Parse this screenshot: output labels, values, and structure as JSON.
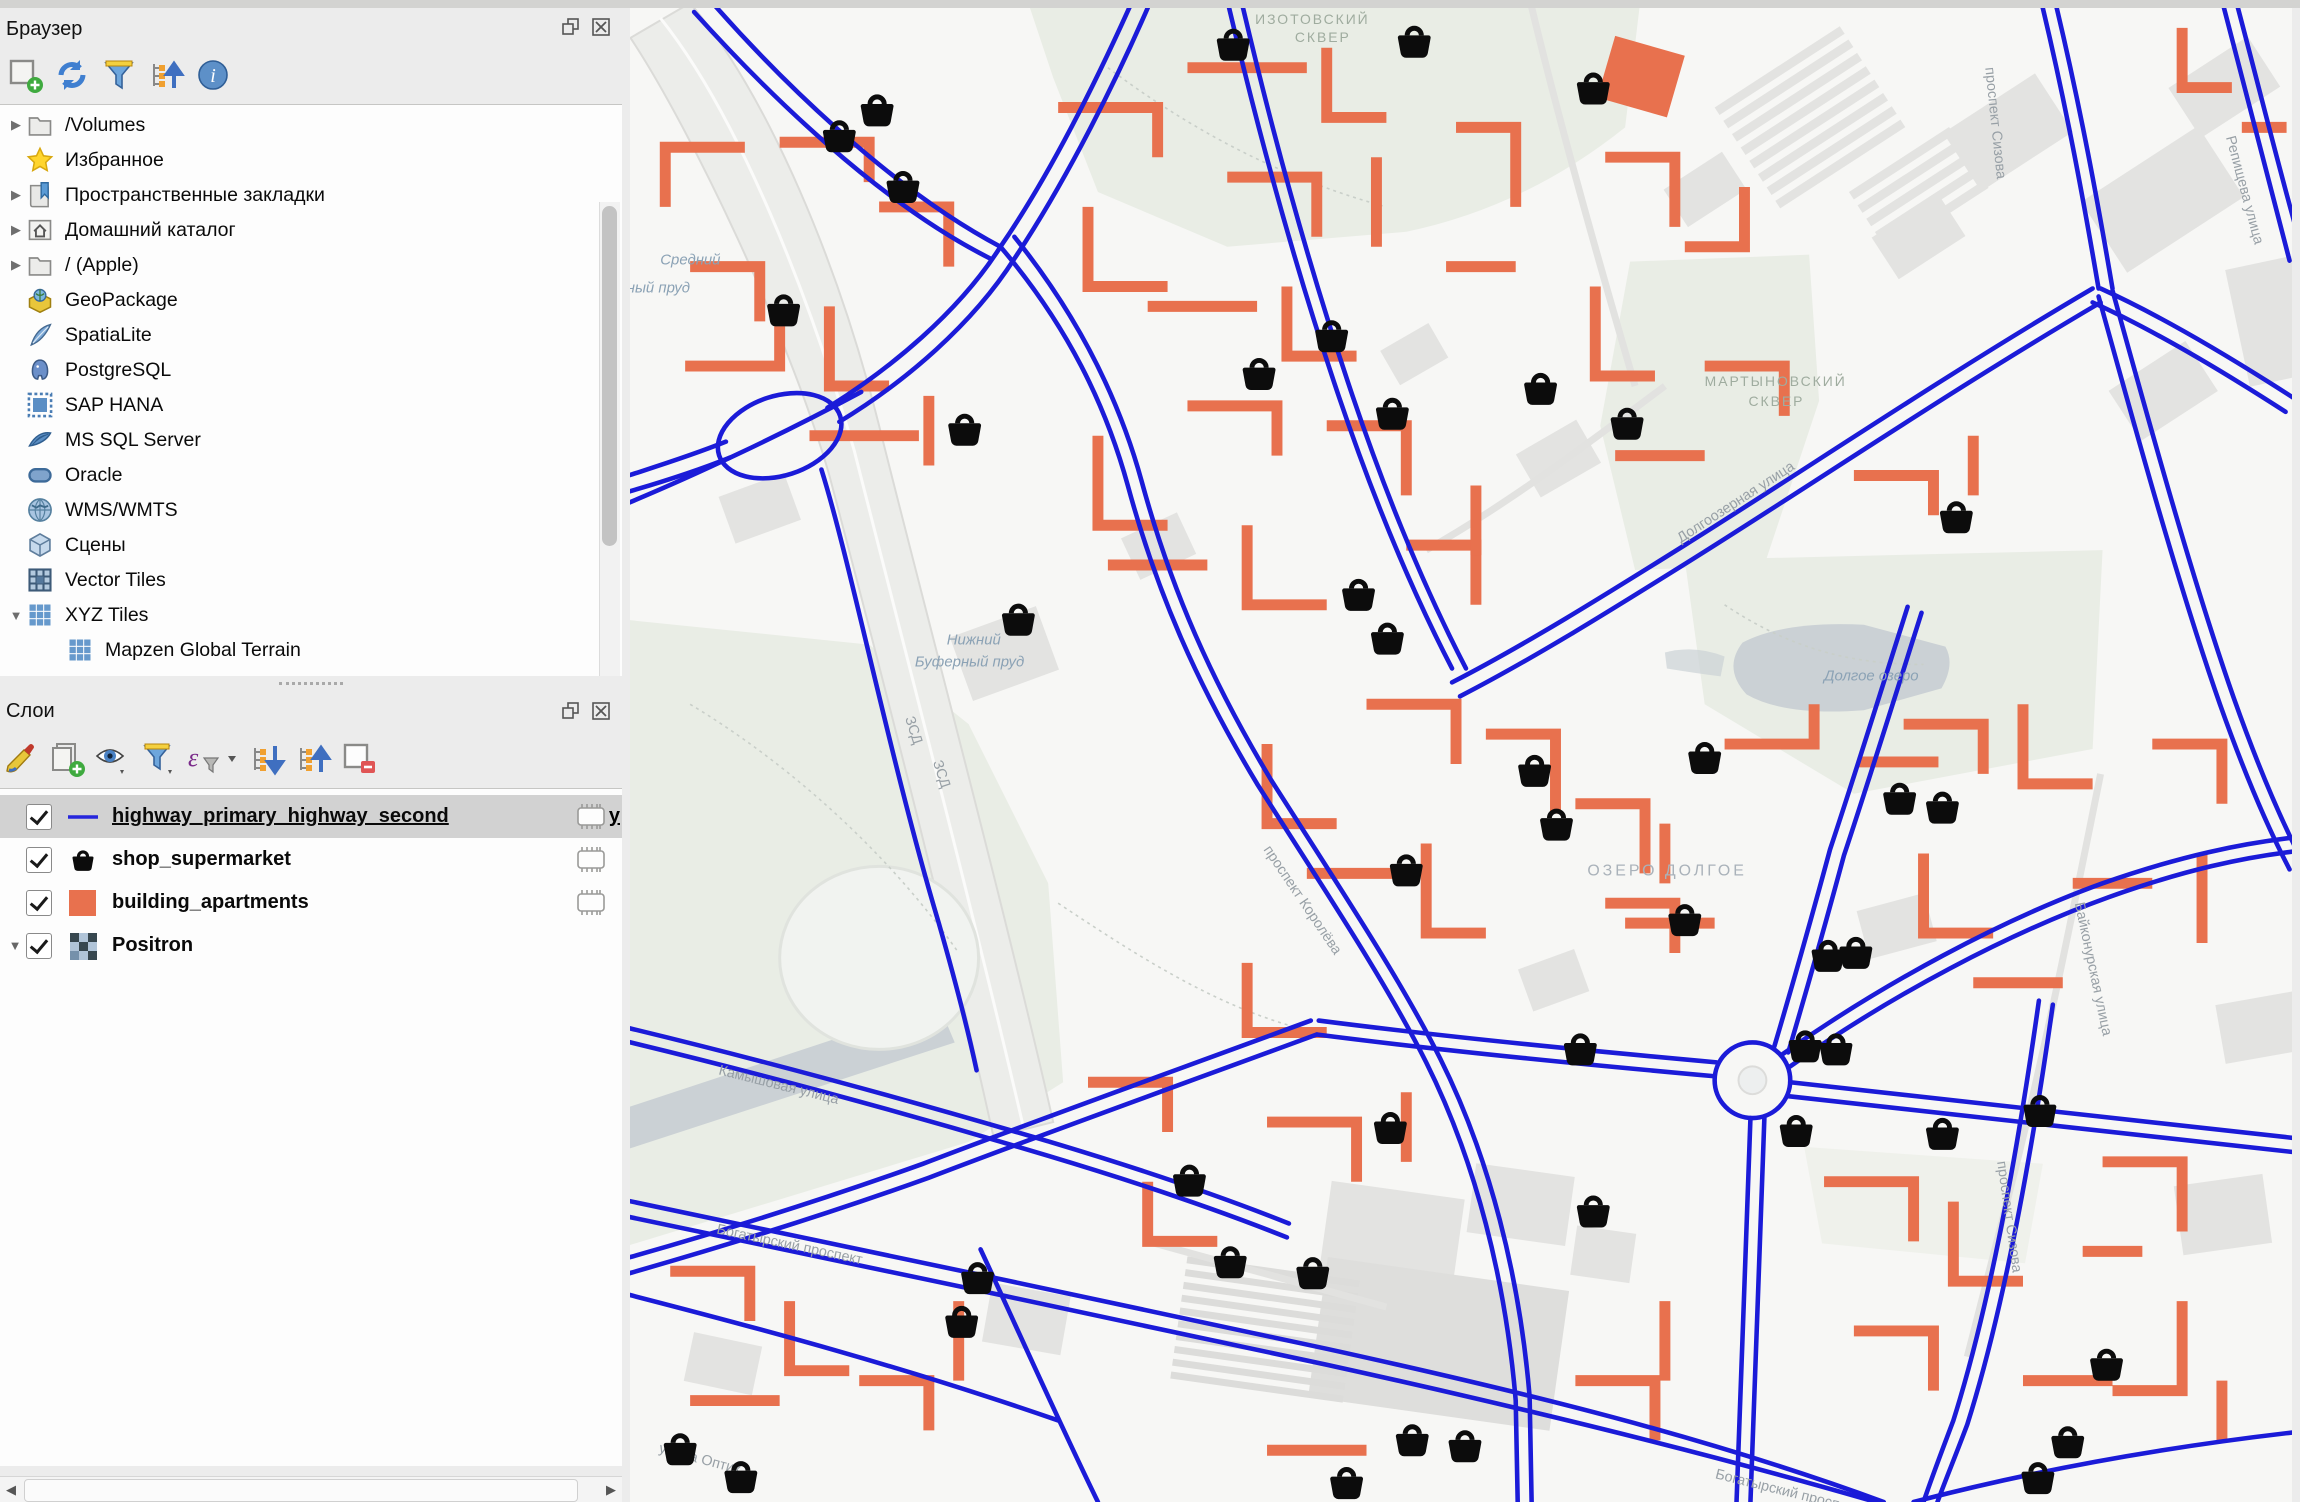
{
  "browser_panel": {
    "title": "Браузер",
    "toolbar": [
      {
        "name": "add-favorite",
        "icon": "add-square-icon"
      },
      {
        "name": "refresh",
        "icon": "refresh-icon"
      },
      {
        "name": "filter-browser",
        "icon": "filter-icon"
      },
      {
        "name": "collapse-all",
        "icon": "collapse-tree-icon"
      },
      {
        "name": "properties",
        "icon": "info-icon"
      }
    ],
    "items": [
      {
        "label": "/Volumes",
        "icon": "folder-icon",
        "expander": "collapsed"
      },
      {
        "label": "Избранное",
        "icon": "star-icon",
        "expander": "none"
      },
      {
        "label": "Пространственные закладки",
        "icon": "bookmarks-icon",
        "expander": "collapsed"
      },
      {
        "label": "Домашний каталог",
        "icon": "home-folder-icon",
        "expander": "collapsed"
      },
      {
        "label": "/ (Apple)",
        "icon": "folder-icon",
        "expander": "collapsed"
      },
      {
        "label": "GeoPackage",
        "icon": "geopackage-icon",
        "expander": "none"
      },
      {
        "label": "SpatiaLite",
        "icon": "spatialite-icon",
        "expander": "none"
      },
      {
        "label": "PostgreSQL",
        "icon": "postgresql-icon",
        "expander": "none"
      },
      {
        "label": "SAP HANA",
        "icon": "sap-hana-icon",
        "expander": "none"
      },
      {
        "label": "MS SQL Server",
        "icon": "mssql-icon",
        "expander": "none"
      },
      {
        "label": "Oracle",
        "icon": "oracle-icon",
        "expander": "none"
      },
      {
        "label": "WMS/WMTS",
        "icon": "wms-icon",
        "expander": "none"
      },
      {
        "label": "Сцены",
        "icon": "scenes-icon",
        "expander": "none"
      },
      {
        "label": "Vector Tiles",
        "icon": "vector-tiles-icon",
        "expander": "none"
      },
      {
        "label": "XYZ Tiles",
        "icon": "xyz-tiles-icon",
        "expander": "expanded"
      },
      {
        "label": "Mapzen Global Terrain",
        "icon": "xyz-tiles-icon",
        "expander": "none",
        "indent": 1
      }
    ]
  },
  "layers_panel": {
    "title": "Слои",
    "toolbar": [
      {
        "name": "layer-styling",
        "icon": "paintbrush-icon"
      },
      {
        "name": "add-group",
        "icon": "add-group-icon"
      },
      {
        "name": "manage-visibility",
        "icon": "eye-icon"
      },
      {
        "name": "filter-legend",
        "icon": "filter-icon"
      },
      {
        "name": "filter-by-expression",
        "icon": "expression-filter-icon"
      },
      {
        "name": "expand-all",
        "icon": "expand-tree-icon"
      },
      {
        "name": "collapse-all",
        "icon": "collapse-tree-icon"
      },
      {
        "name": "remove-layer",
        "icon": "remove-layer-icon"
      }
    ],
    "layers": [
      {
        "label": "highway_primary_highway_second",
        "label_tail": "y",
        "checked": true,
        "selected": true,
        "swatch": "blue-line",
        "swatch_color": "#2626DC",
        "memory_indicator": true
      },
      {
        "label": "shop_supermarket",
        "checked": true,
        "selected": false,
        "swatch": "basket-marker",
        "swatch_color": "#0C0C0C",
        "memory_indicator": true
      },
      {
        "label": "building_apartments",
        "checked": true,
        "selected": false,
        "swatch": "fill-square",
        "swatch_color": "#E8714E",
        "memory_indicator": true
      },
      {
        "label": "Positron",
        "checked": true,
        "selected": false,
        "swatch": "raster-checker",
        "expander": "expanded",
        "memory_indicator": false
      }
    ]
  },
  "map": {
    "basemap": "Positron",
    "colors": {
      "road_blue": "#1B1BD8",
      "building_orange": "#E8714E",
      "marker_black": "#0C0C0C",
      "park_green": "#E9EDE5",
      "water_gray": "#CBD1D5",
      "basemap_building": "#E3E3E1",
      "background": "#F7F7F5"
    },
    "marker": "shopping-basket-icon",
    "marker_count": 47,
    "labels": [
      {
        "text": "ИЗОТОВСКИЙ",
        "x": 628,
        "y": 16,
        "type": "park"
      },
      {
        "text": "СКВЕР",
        "x": 668,
        "y": 34,
        "type": "park"
      },
      {
        "text": "Средний",
        "x": 30,
        "y": 258,
        "type": "water"
      },
      {
        "text": "Буферный пруд",
        "x": -50,
        "y": 286,
        "type": "water"
      },
      {
        "text": "МАРТЫНОВСКИЙ",
        "x": 1080,
        "y": 380,
        "type": "park"
      },
      {
        "text": "СКВЕР",
        "x": 1124,
        "y": 400,
        "type": "park"
      },
      {
        "text": "Нижний",
        "x": 318,
        "y": 640,
        "type": "water"
      },
      {
        "text": "Буферный пруд",
        "x": 286,
        "y": 662,
        "type": "water"
      },
      {
        "text": "Долгое озеро",
        "x": 1200,
        "y": 676,
        "type": "water"
      },
      {
        "text": "ОЗЕРО ДОЛГОЕ",
        "x": 962,
        "y": 872,
        "type": "district"
      },
      {
        "text": "ЗСД",
        "x": 276,
        "y": 714,
        "type": "street",
        "rotation": 72
      },
      {
        "text": "ЗСД",
        "x": 304,
        "y": 758,
        "type": "street",
        "rotation": 72
      },
      {
        "text": "Долгоозерная улица",
        "x": 1056,
        "y": 538,
        "type": "street",
        "rotation": -33
      },
      {
        "text": "Байконурская улица",
        "x": 1452,
        "y": 900,
        "type": "street",
        "rotation": 78
      },
      {
        "text": "проспект Сизова",
        "x": 1374,
        "y": 1160,
        "type": "street",
        "rotation": 82
      },
      {
        "text": "проспект Сизова",
        "x": 1362,
        "y": 60,
        "type": "street",
        "rotation": 84
      },
      {
        "text": "Богатырский проспект",
        "x": 86,
        "y": 1232,
        "type": "street",
        "rotation": 12
      },
      {
        "text": "Богатырский проспект",
        "x": 1090,
        "y": 1478,
        "type": "street",
        "rotation": 14
      },
      {
        "text": "Камышовая улица",
        "x": 88,
        "y": 1072,
        "type": "street",
        "rotation": 14
      },
      {
        "text": "улица Оптик",
        "x": 28,
        "y": 1452,
        "type": "street",
        "rotation": 15
      },
      {
        "text": "проспект Королёва",
        "x": 636,
        "y": 846,
        "type": "street",
        "rotation": 56
      },
      {
        "text": "Репищева улица",
        "x": 1604,
        "y": 130,
        "type": "street",
        "rotation": 75
      }
    ]
  }
}
